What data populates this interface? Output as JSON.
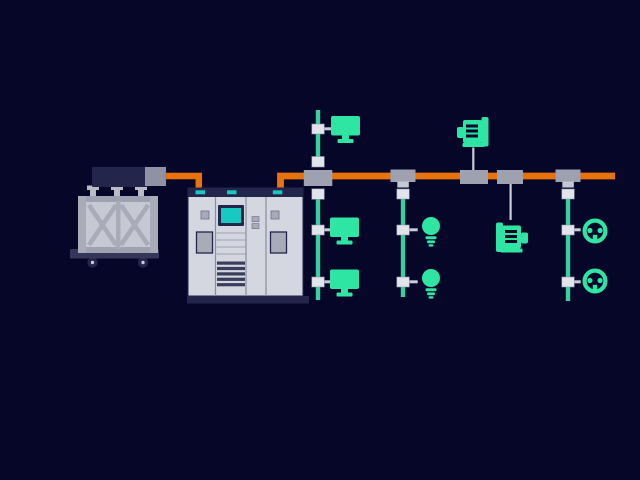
{
  "colors": {
    "bg": "#060629",
    "orange": "#E8730D",
    "green": "#2EE5A4",
    "green-line": "#36D19E",
    "teal": "#17C9C0",
    "gray-50": "#E2E4EC",
    "gray-100": "#D4D6E0",
    "gray-200": "#C6C8D3",
    "gray-300": "#A9ABB9",
    "gray-400": "#9EA1B0",
    "gray-500": "#8F92A4",
    "navy-700": "#343757",
    "navy-900": "#23254A",
    "line-gray": "#C9CBD8"
  },
  "scene": {
    "type": "illustration",
    "subject": "electrical-power-distribution",
    "text_labels": [],
    "components": [
      {
        "id": "transformer",
        "kind": "transformer",
        "bushings": 3,
        "wheels": 2
      },
      {
        "id": "hv-cable",
        "kind": "cable",
        "color_ref": "orange"
      },
      {
        "id": "switchgear-cabinet",
        "kind": "switchgear",
        "panels": 4,
        "status_lights": 3,
        "screen": true,
        "vent_slats": 5
      },
      {
        "id": "busbar",
        "kind": "busbar",
        "color_ref": "orange",
        "junctions": 5
      },
      {
        "id": "feeder-1",
        "kind": "feeder",
        "loads": [
          "monitor",
          "monitor",
          "monitor"
        ],
        "first_load_above_bus": true
      },
      {
        "id": "feeder-2",
        "kind": "feeder",
        "loads": [
          "bulb",
          "bulb"
        ]
      },
      {
        "id": "motor-drop-up",
        "kind": "drop",
        "loads": [
          "motor"
        ],
        "above_bus": true
      },
      {
        "id": "motor-drop-down",
        "kind": "drop",
        "loads": [
          "motor"
        ]
      },
      {
        "id": "feeder-3",
        "kind": "feeder",
        "loads": [
          "outlet",
          "outlet"
        ]
      }
    ]
  }
}
